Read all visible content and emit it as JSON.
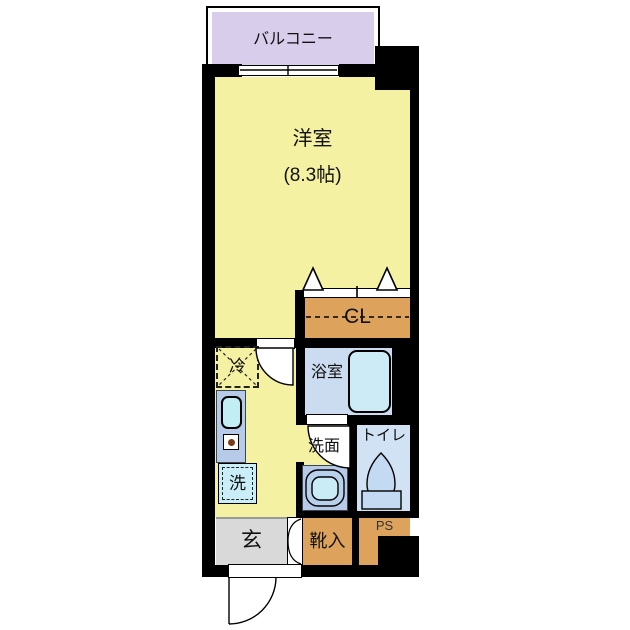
{
  "plan": {
    "type": "apartment-floor-plan",
    "rooms": {
      "balcony": {
        "label": "バルコニー"
      },
      "main_room": {
        "label": "洋室",
        "size": "(8.3帖)"
      },
      "closet": {
        "label": "CL"
      },
      "fridge": {
        "label": "冷"
      },
      "washer": {
        "label": "洗"
      },
      "bathroom": {
        "label": "浴室"
      },
      "washroom": {
        "label": "洗面"
      },
      "toilet": {
        "label": "トイレ"
      },
      "entrance": {
        "label": "玄"
      },
      "shoe_box": {
        "label": "靴入"
      },
      "pipe_space": {
        "label": "PS"
      }
    },
    "colors": {
      "wall": "#000000",
      "room_yellow": "#f5f1a2",
      "balcony_lavender": "#d8cdeb",
      "storage_orange": "#dda35d",
      "entrance_gray": "#d9d9d9",
      "bath_periwinkle": "#ccdcf0",
      "toilet_blue": "#d2e2f5",
      "fixture_cyan": "#c9edf6",
      "counter_blue": "#b7cbe9"
    }
  }
}
